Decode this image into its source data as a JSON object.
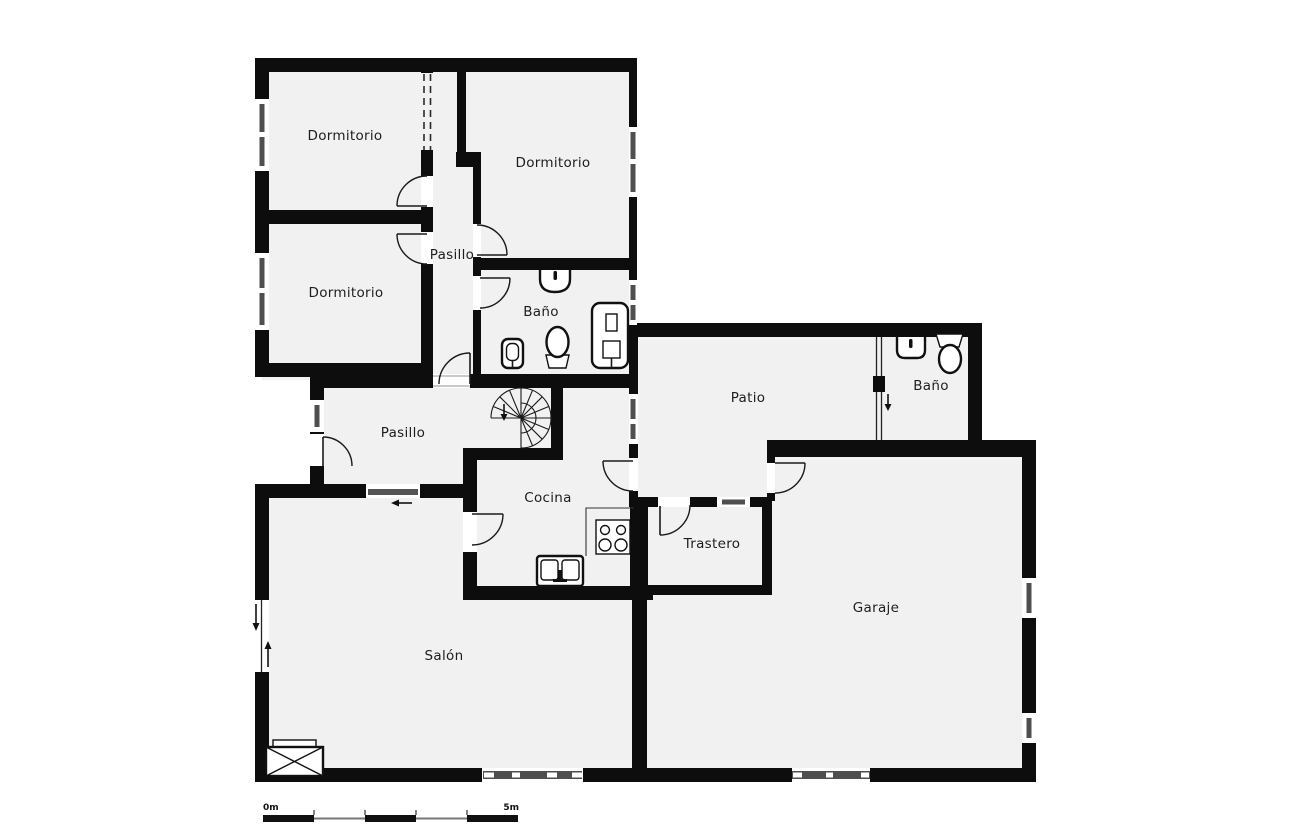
{
  "document": {
    "type": "floor-plan",
    "language": "Spanish"
  },
  "rooms": {
    "dormitorio_1": {
      "label": "Dormitorio"
    },
    "dormitorio_2": {
      "label": "Dormitorio"
    },
    "dormitorio_3": {
      "label": "Dormitorio"
    },
    "pasillo_1": {
      "label": "Pasillo"
    },
    "pasillo_2": {
      "label": "Pasillo"
    },
    "bano_1": {
      "label": "Baño"
    },
    "bano_2": {
      "label": "Baño"
    },
    "patio": {
      "label": "Patio"
    },
    "cocina": {
      "label": "Cocina"
    },
    "trastero": {
      "label": "Trastero"
    },
    "garaje": {
      "label": "Garaje"
    },
    "salon": {
      "label": "Salón"
    }
  },
  "scale_bar": {
    "start_label": "0m",
    "end_label": "5m"
  },
  "colors": {
    "wall": "#0d0d0d",
    "floor_fill": "#f1f1f1",
    "background": "#ffffff",
    "window_glass": "#4f4f4f",
    "door_arc": "#1a1a1a"
  },
  "fixtures": [
    "spiral-staircase",
    "washbasin",
    "toilet",
    "bidet",
    "shower-column",
    "kitchen-sink",
    "stove",
    "fireplace",
    "wardrobe-dashed-opening"
  ]
}
